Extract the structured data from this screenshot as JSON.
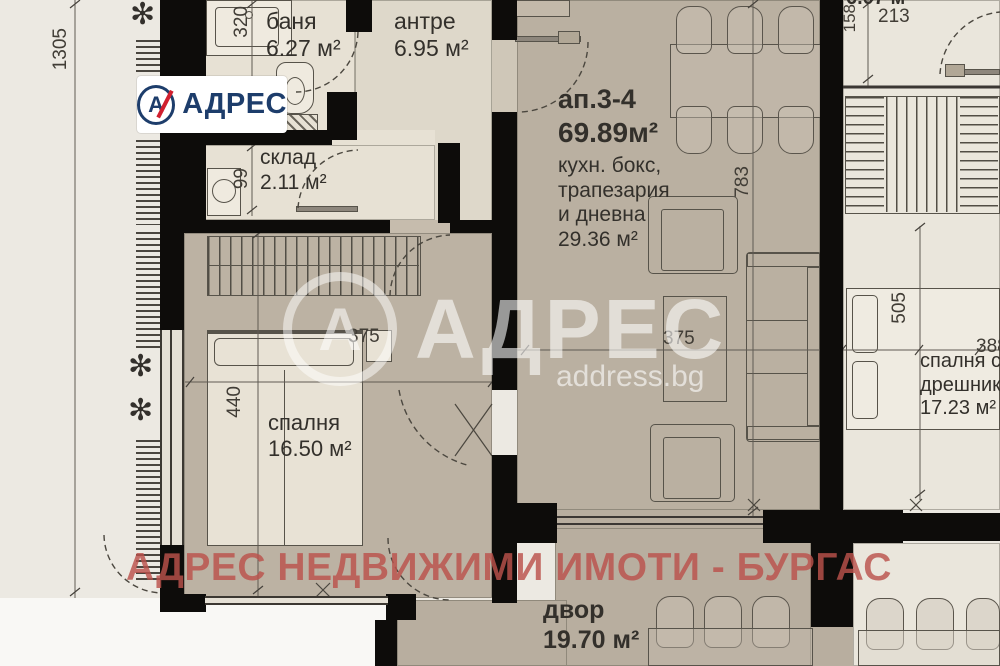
{
  "logo": {
    "brand": "АДРЕС"
  },
  "watermarks": {
    "center_brand": "АДРЕС",
    "center_icon_letter": "А",
    "center_site": "address.bg",
    "footer": "АДРЕС НЕДВИЖИМИ ИМОТИ - БУРГАС"
  },
  "unit": {
    "id": "ап.3-4",
    "total_area": "69.89м²",
    "living_lines": [
      "кухн. бокс,",
      "трапезария",
      "и дневна"
    ],
    "living_area": "29.36 м²"
  },
  "rooms": {
    "bathroom": {
      "name": "баня",
      "area": "6.27 м²"
    },
    "hallway": {
      "name": "антре",
      "area": "6.95 м²"
    },
    "storage": {
      "name": "склад",
      "area": "2.11 м²"
    },
    "bedroom": {
      "name": "спалня",
      "area": "16.50 м²"
    },
    "yard": {
      "name": "двор",
      "area": "19.70 м²"
    },
    "adjacent_bedroom": {
      "name_line1": "спалня с",
      "name_line2": "дрешник",
      "area": "17.23 м²"
    },
    "adjacent_area_partial": "6.07 м"
  },
  "dimensions": {
    "left_outer": "1305",
    "bath_width": "320",
    "storage_width": "99",
    "bedroom_depth": "440",
    "bedroom_width": "375",
    "living_width": "375",
    "living_depth": "783",
    "adj_depth": "505",
    "adj_width": "388",
    "adj_d1": "158",
    "adj_d2": "213"
  },
  "colors": {
    "brand_navy": "#1d3d6b",
    "brand_red": "#d01f2e",
    "wall": "#0d0c0a",
    "floor_main": "#bab0a1",
    "floor_light": "#e7e1d4",
    "floor_adjacent": "#eae6dc",
    "watermark_red": "#bb544e"
  }
}
